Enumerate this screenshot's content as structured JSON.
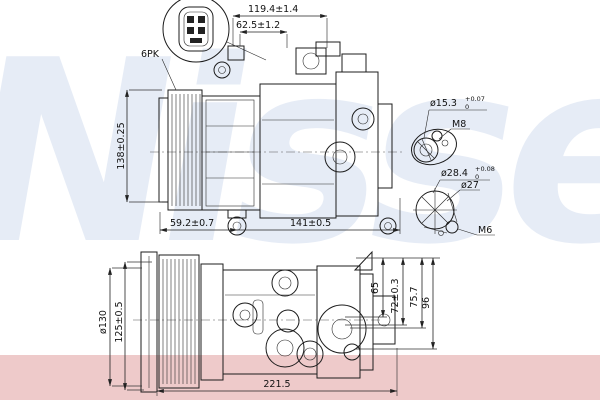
{
  "watermark": {
    "brand": "Nissens",
    "blue": "#5a82c3",
    "pink_band": "#eecaca"
  },
  "drawing": {
    "line_color": "#1c1c1c",
    "annotations": {
      "belt_type": "6PK",
      "dim_total_width_top": "119.4±1.4",
      "dim_front_width_top": "62.5±1.2",
      "dim_height": "138±0.25",
      "dim_pulley_offset": "59.2±0.7",
      "dim_body_length": "141±0.5",
      "port_small": {
        "dia": "ø15.3",
        "tol_plus": "+0.07",
        "tol_minus": "0",
        "thread": "M8"
      },
      "port_large": {
        "dia": "ø28.4",
        "tol_plus": "+0.08",
        "tol_minus": "0",
        "inner_dia": "ø27",
        "thread": "M6"
      },
      "pulley_dia": "ø130",
      "dim_pulley_height": "125±0.5",
      "dim_65": "65",
      "dim_72": "72±0.3",
      "dim_75_7": "75.7",
      "dim_96": "96",
      "dim_total_length": "221.5"
    }
  }
}
